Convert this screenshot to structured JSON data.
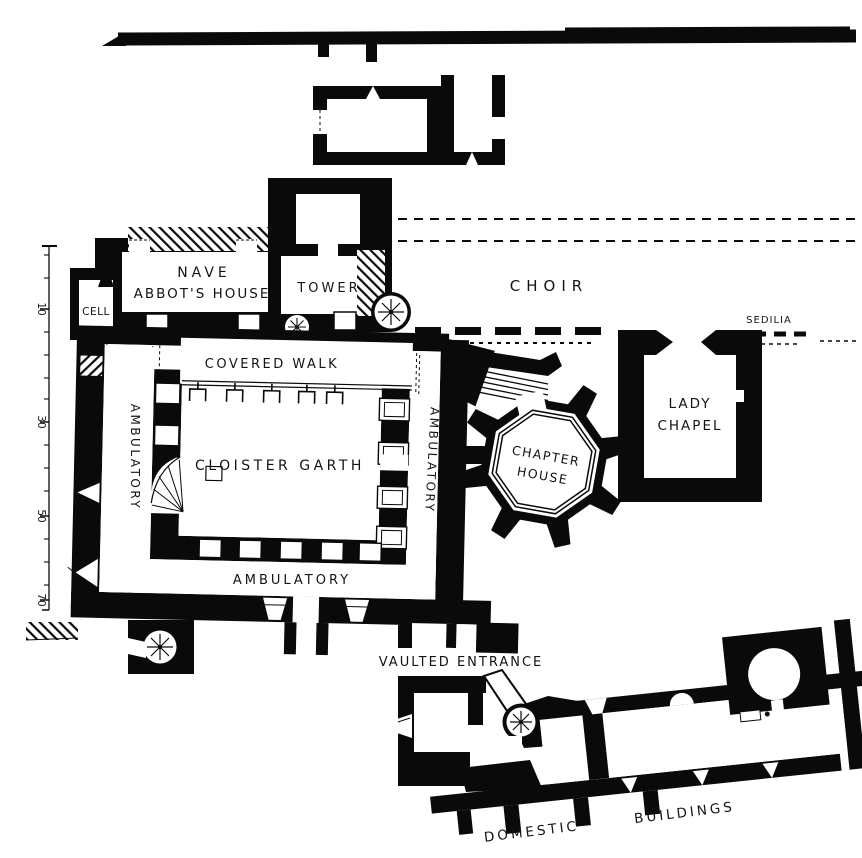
{
  "colors": {
    "ink": "#0a0a0a",
    "paper": "#ffffff"
  },
  "plan": {
    "rooms": {
      "nave": "NAVE",
      "abbots_house": "ABBOT'S HOUSE",
      "cell": "CELL",
      "tower": "TOWER",
      "choir": "CHOIR",
      "sedilia": "SEDILIA",
      "covered_walk": "COVERED WALK",
      "cloister_garth": "CLOISTER GARTH",
      "ambulatory_west": "AMBULATORY",
      "ambulatory_east": "AMBULATORY",
      "ambulatory_south": "AMBULATORY",
      "chapter_house_line1": "CHAPTER",
      "chapter_house_line2": "HOUSE",
      "lady_chapel_line1": "LADY",
      "lady_chapel_line2": "CHAPEL",
      "vaulted_entrance": "VAULTED ENTRANCE",
      "domestic": "DOMESTIC",
      "buildings": "BUILDINGS"
    },
    "scale_bar": {
      "ticks": [
        "10",
        "30",
        "50",
        "70"
      ]
    }
  }
}
